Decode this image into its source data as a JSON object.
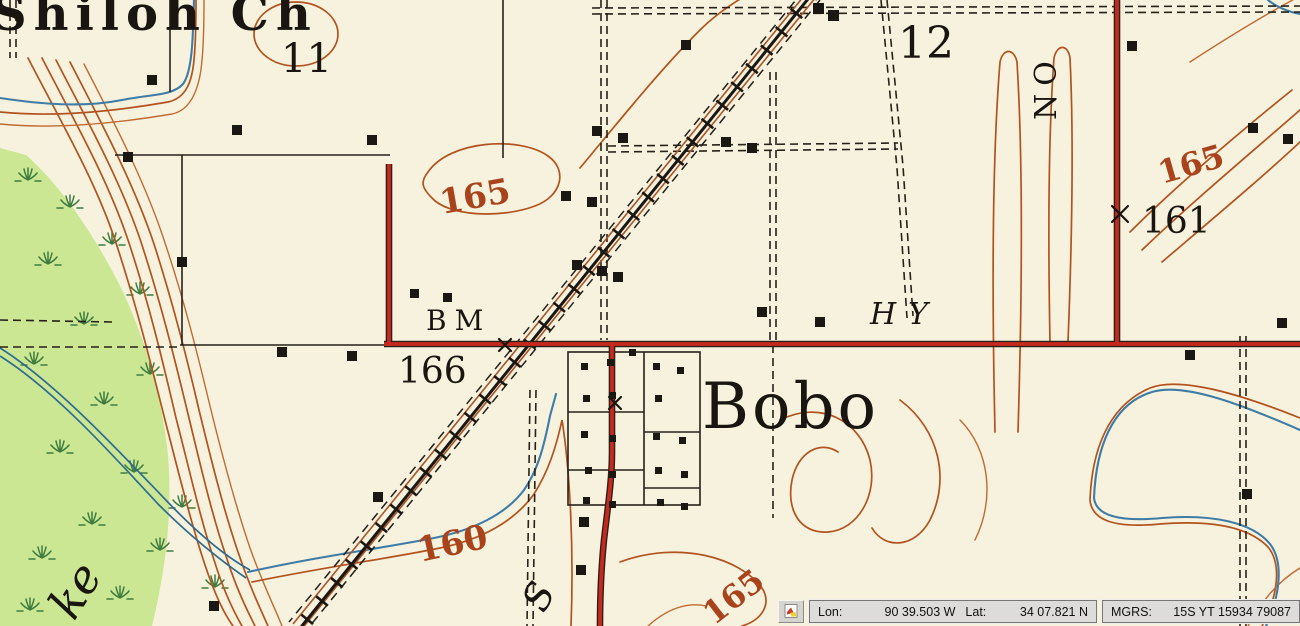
{
  "map_labels": {
    "church_partial": "Shiloh Ch",
    "section_11": "11",
    "section_12": "12",
    "contour_165_west": "165",
    "contour_165_northeast": "165",
    "contour_165_south": "165",
    "contour_160": "160",
    "benchmark": "BM",
    "benchmark_elevation": "166",
    "town_name": "Bobo",
    "spot_elevation": "161",
    "highway_label": "HY",
    "highway_label_vertical": "NO",
    "road_letter_south": "S",
    "lake_partial": "ke"
  },
  "statusbar": {
    "lon_label": "Lon:",
    "lon_value": "90 39.503 W",
    "lat_label": "Lat:",
    "lat_value": "34 07.821 N",
    "mgrs_label": "MGRS:",
    "mgrs_value": "15S YT 15934 79087"
  },
  "colors": {
    "map_background": "#f7f2dd",
    "vegetation_green": "#cbe794",
    "marsh_green": "#3f7d3f",
    "contour_brown": "#b2531f",
    "road_red": "#c9281c",
    "water_blue": "#3e7ca7",
    "ink_black": "#1b1712",
    "statusbar_gray": "#dddcda"
  }
}
